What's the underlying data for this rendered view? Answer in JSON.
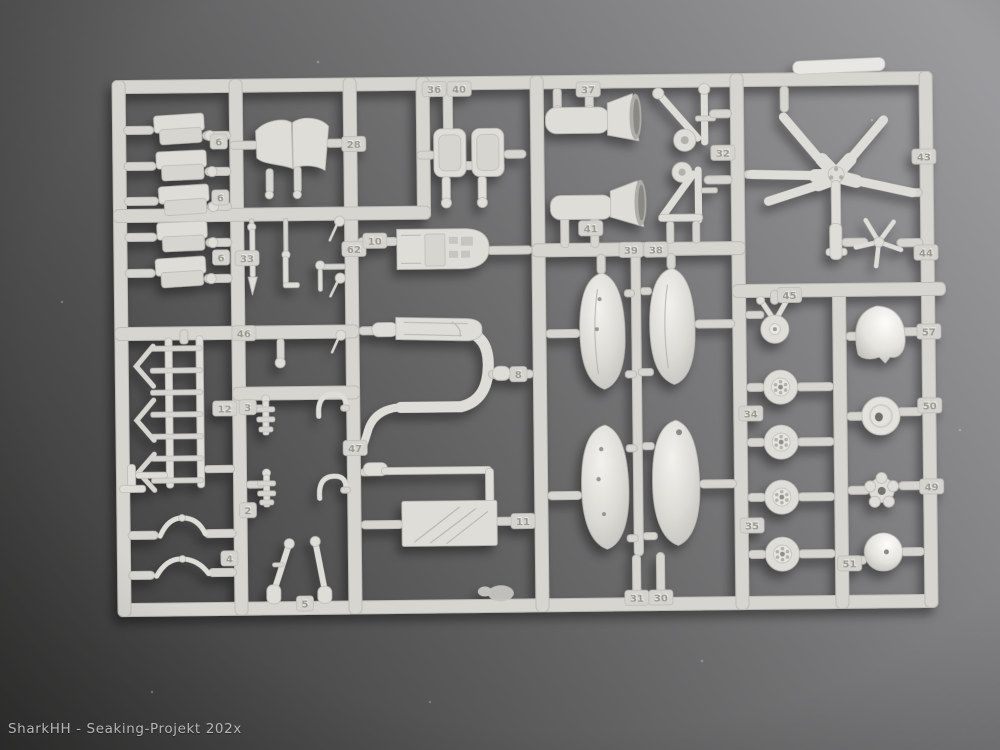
{
  "scene": {
    "description": "Photograph of a light grey injection-moulded model kit sprue (Sea King helicopter parts tree) lying on a grey surface lit from the top right",
    "watermark": "SharkHH - Seaking-Projekt 202x"
  },
  "colors": {
    "background_dark": "#343433",
    "background_light": "#9b9b9e",
    "plastic": "#d6d5d0",
    "plastic_light": "#deddd8",
    "plastic_bright": "#efeeea",
    "plastic_edge": "#bdbcb7",
    "plastic_dark": "#aeada8",
    "tag_background": "#d4d3ce",
    "tag_digit": "#9a998f",
    "tag_digit_highlight": "#eeede9",
    "watermark_text": "#b6b6b6"
  },
  "sprue": {
    "material": "light grey polystyrene",
    "part_tags": [
      {
        "label": "6",
        "x": 221,
        "y": 138
      },
      {
        "label": "6",
        "x": 222,
        "y": 194
      },
      {
        "label": "6",
        "x": 222,
        "y": 254
      },
      {
        "label": "33",
        "x": 248,
        "y": 255
      },
      {
        "label": "46",
        "x": 244,
        "y": 330
      },
      {
        "label": "12",
        "x": 224,
        "y": 405
      },
      {
        "label": "3",
        "x": 247,
        "y": 404
      },
      {
        "label": "2",
        "x": 246,
        "y": 507
      },
      {
        "label": "4",
        "x": 227,
        "y": 555
      },
      {
        "label": "5",
        "x": 302,
        "y": 601
      },
      {
        "label": "28",
        "x": 356,
        "y": 142
      },
      {
        "label": "62",
        "x": 355,
        "y": 247
      },
      {
        "label": "10",
        "x": 376,
        "y": 239
      },
      {
        "label": "47",
        "x": 354,
        "y": 446
      },
      {
        "label": "8",
        "x": 518,
        "y": 374
      },
      {
        "label": "11",
        "x": 521,
        "y": 521
      },
      {
        "label": "36",
        "x": 437,
        "y": 88
      },
      {
        "label": "40",
        "x": 462,
        "y": 88
      },
      {
        "label": "37",
        "x": 591,
        "y": 90
      },
      {
        "label": "41",
        "x": 592,
        "y": 229
      },
      {
        "label": "32",
        "x": 725,
        "y": 155
      },
      {
        "label": "39",
        "x": 632,
        "y": 251
      },
      {
        "label": "38",
        "x": 657,
        "y": 251
      },
      {
        "label": "31",
        "x": 634,
        "y": 599
      },
      {
        "label": "30",
        "x": 658,
        "y": 599
      },
      {
        "label": "43",
        "x": 926,
        "y": 161
      },
      {
        "label": "44",
        "x": 927,
        "y": 257
      },
      {
        "label": "45",
        "x": 790,
        "y": 298
      },
      {
        "label": "34",
        "x": 750,
        "y": 416
      },
      {
        "label": "35",
        "x": 750,
        "y": 528
      },
      {
        "label": "57",
        "x": 929,
        "y": 336
      },
      {
        "label": "50",
        "x": 929,
        "y": 410
      },
      {
        "label": "49",
        "x": 930,
        "y": 491
      },
      {
        "label": "51",
        "x": 847,
        "y": 567
      }
    ],
    "parts_catalog": [
      {
        "tag": "2",
        "shape": "small knobbed stick"
      },
      {
        "tag": "3",
        "shape": "small knobbed stick"
      },
      {
        "tag": "4",
        "shape": "curved handle"
      },
      {
        "tag": "5",
        "shape": "angled landing gear legs"
      },
      {
        "tag": "6",
        "shape": "folded troop seats, row of five"
      },
      {
        "tag": "8",
        "shape": "large U-shaped cabin frame"
      },
      {
        "tag": "10",
        "shape": "cockpit floor with centre console"
      },
      {
        "tag": "11",
        "shape": "rectangular bulkhead panel"
      },
      {
        "tag": "12",
        "shape": "ladder-like seat rack"
      },
      {
        "tag": "28",
        "shape": "folded intake cowling"
      },
      {
        "tag": "30",
        "shape": "sponson float half"
      },
      {
        "tag": "31",
        "shape": "sponson float half"
      },
      {
        "tag": "32",
        "shape": "triangular gear struts with small wheels"
      },
      {
        "tag": "33",
        "shape": "troop seat"
      },
      {
        "tag": "34",
        "shape": "main wheel"
      },
      {
        "tag": "35",
        "shape": "main wheel"
      },
      {
        "tag": "36",
        "shape": "pilot seat"
      },
      {
        "tag": "37",
        "shape": "horn-shaped exhaust"
      },
      {
        "tag": "38",
        "shape": "sponson float half"
      },
      {
        "tag": "39",
        "shape": "sponson float half"
      },
      {
        "tag": "40",
        "shape": "pilot seat"
      },
      {
        "tag": "41",
        "shape": "horn-shaped exhaust"
      },
      {
        "tag": "43",
        "shape": "five-blade main rotor head"
      },
      {
        "tag": "44",
        "shape": "five-blade tail rotor"
      },
      {
        "tag": "45",
        "shape": "tail wheel with fork"
      },
      {
        "tag": "46",
        "shape": "pitot / antenna pins"
      },
      {
        "tag": "47",
        "shape": "curved handle"
      },
      {
        "tag": "49",
        "shape": "five-lobed hub plate"
      },
      {
        "tag": "50",
        "shape": "flat disc with centre hole"
      },
      {
        "tag": "51",
        "shape": "glossy dome ball"
      },
      {
        "tag": "57",
        "shape": "nose dome"
      },
      {
        "tag": "62",
        "shape": "small ball fittings"
      }
    ]
  }
}
